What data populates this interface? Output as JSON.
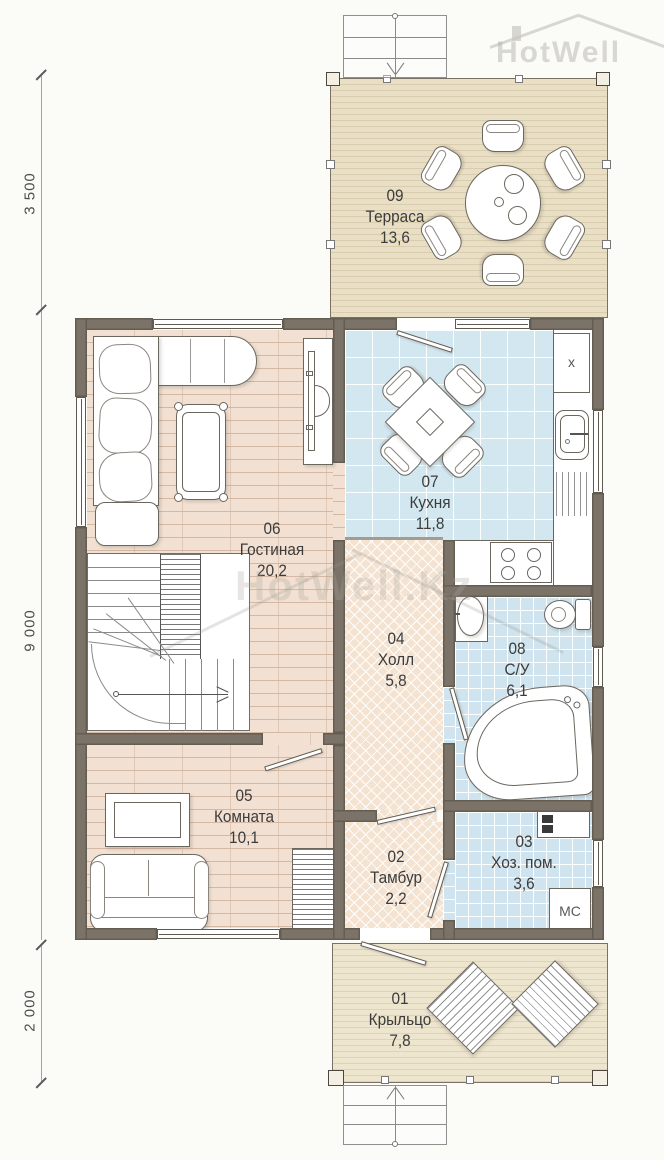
{
  "watermarks": {
    "logo_text": "HotWell",
    "center_text": "HotWell.Kz"
  },
  "dimensions": {
    "terrace_height": "3 500",
    "house_height": "9 000",
    "porch_height": "2 000"
  },
  "rooms": {
    "porch": {
      "number": "01",
      "name": "Крыльцо",
      "area": "7,8"
    },
    "tambour": {
      "number": "02",
      "name": "Тамбур",
      "area": "2,2"
    },
    "utility": {
      "number": "03",
      "name": "Хоз. пом.",
      "area": "3,6"
    },
    "hall": {
      "number": "04",
      "name": "Холл",
      "area": "5,8"
    },
    "room": {
      "number": "05",
      "name": "Комната",
      "area": "10,1"
    },
    "living": {
      "number": "06",
      "name": "Гостиная",
      "area": "20,2"
    },
    "kitchen": {
      "number": "07",
      "name": "Кухня",
      "area": "11,8"
    },
    "bathroom": {
      "number": "08",
      "name": "С/У",
      "area": "6,1"
    },
    "terrace": {
      "number": "09",
      "name": "Терраса",
      "area": "13,6"
    }
  },
  "appliances": {
    "washing_machine": "МС",
    "x_mark": "x"
  },
  "colors": {
    "wall": "#7c7368",
    "tile": "#d2e7f0",
    "wood_floor": "#f2e1d2",
    "herringbone": "#f5e3d2",
    "deck": "#e9dfc6",
    "label_text": "#3c3c3c"
  }
}
